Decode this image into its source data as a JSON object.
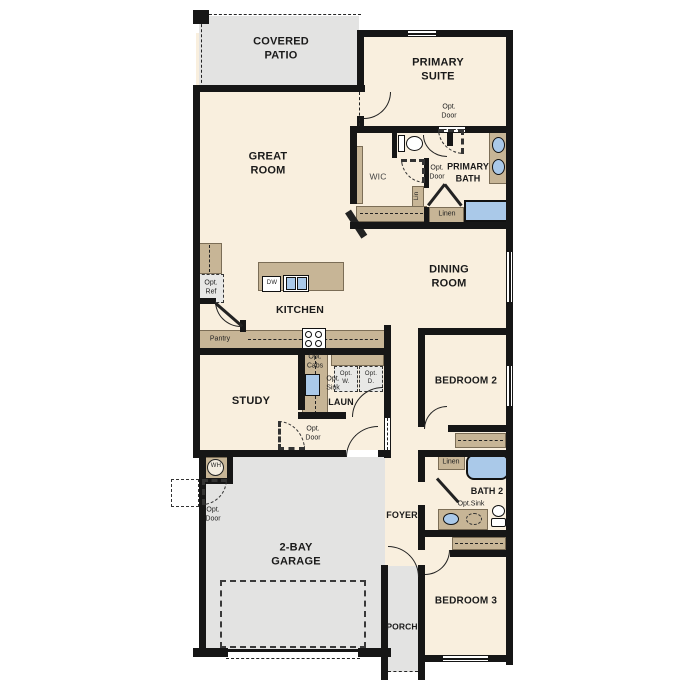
{
  "colors": {
    "wall": "#161616",
    "floor": "#f9efde",
    "outdoor": "#e3e3e2",
    "cab": "#c7b596",
    "fixture": "#aac9e9",
    "appliance": "#e8e8e6"
  },
  "labels": {
    "covered_patio": "COVERED\nPATIO",
    "primary_suite": "PRIMARY\nSUITE",
    "great_room": "GREAT\nROOM",
    "dining_room": "DINING\nROOM",
    "kitchen": "KITCHEN",
    "study": "STUDY",
    "laundry": "LAUN",
    "foyer": "FOYER",
    "porch": "PORCH",
    "garage": "2-BAY\nGARAGE",
    "bedroom2": "BEDROOM 2",
    "bedroom3": "BEDROOM 3",
    "bath2": "BATH 2",
    "primary_bath": "PRIMARY\nBATH",
    "wic": "WIC",
    "pantry": "Pantry",
    "linen_primary": "Linen",
    "linen_hall": "Linen",
    "lin_closet": "Lin",
    "wh": "WH",
    "dw": "DW",
    "opt_ref": "Opt.\nRef",
    "opt_cabs": "Opt.\nCabs",
    "opt_sink_laundry": "Opt.\nSink",
    "opt_washer": "Opt.\nW.",
    "opt_dryer": "Opt.\nD.",
    "opt_sink_bath2": "Opt.Sink",
    "opt_door_primary": "Opt.\nDoor",
    "opt_door_wic": "Opt.\nDoor",
    "opt_door_study": "Opt.\nDoor",
    "opt_door_garage": "Opt.\nDoor"
  }
}
